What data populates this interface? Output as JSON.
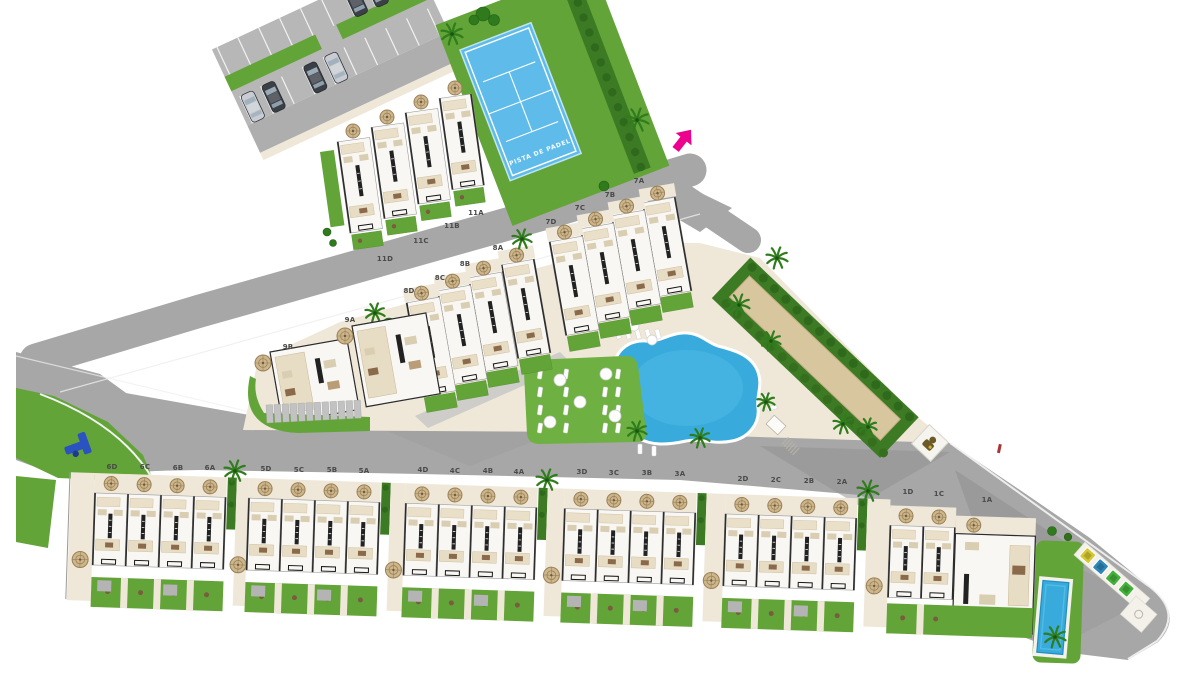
{
  "map": {
    "name": "Residential development site plan",
    "padel_court": {
      "label": "PISTA DE PADEL"
    },
    "unit_labels": [
      {
        "text": "11A",
        "x": 476,
        "y": 215
      },
      {
        "text": "11B",
        "x": 452,
        "y": 228
      },
      {
        "text": "11C",
        "x": 421,
        "y": 243
      },
      {
        "text": "11D",
        "x": 385,
        "y": 261
      },
      {
        "text": "7A",
        "x": 639,
        "y": 183
      },
      {
        "text": "7B",
        "x": 610,
        "y": 197
      },
      {
        "text": "7C",
        "x": 580,
        "y": 210
      },
      {
        "text": "7D",
        "x": 551,
        "y": 224
      },
      {
        "text": "8A",
        "x": 498,
        "y": 250
      },
      {
        "text": "8B",
        "x": 465,
        "y": 266
      },
      {
        "text": "8C",
        "x": 440,
        "y": 280
      },
      {
        "text": "8D",
        "x": 409,
        "y": 293
      },
      {
        "text": "9A",
        "x": 350,
        "y": 322
      },
      {
        "text": "9B",
        "x": 288,
        "y": 349
      },
      {
        "text": "6D",
        "x": 112,
        "y": 469
      },
      {
        "text": "6C",
        "x": 145,
        "y": 469
      },
      {
        "text": "6B",
        "x": 178,
        "y": 470
      },
      {
        "text": "6A",
        "x": 210,
        "y": 470
      },
      {
        "text": "5D",
        "x": 266,
        "y": 471
      },
      {
        "text": "5C",
        "x": 299,
        "y": 472
      },
      {
        "text": "5B",
        "x": 332,
        "y": 472
      },
      {
        "text": "5A",
        "x": 364,
        "y": 473
      },
      {
        "text": "4D",
        "x": 423,
        "y": 472
      },
      {
        "text": "4C",
        "x": 455,
        "y": 473
      },
      {
        "text": "4B",
        "x": 488,
        "y": 473
      },
      {
        "text": "4A",
        "x": 519,
        "y": 474
      },
      {
        "text": "3D",
        "x": 582,
        "y": 474
      },
      {
        "text": "3C",
        "x": 614,
        "y": 475
      },
      {
        "text": "3B",
        "x": 647,
        "y": 475
      },
      {
        "text": "3A",
        "x": 680,
        "y": 476
      },
      {
        "text": "2D",
        "x": 743,
        "y": 481
      },
      {
        "text": "2C",
        "x": 776,
        "y": 482
      },
      {
        "text": "2B",
        "x": 809,
        "y": 483
      },
      {
        "text": "2A",
        "x": 842,
        "y": 484
      },
      {
        "text": "1D",
        "x": 908,
        "y": 494
      },
      {
        "text": "1C",
        "x": 939,
        "y": 496
      },
      {
        "text": "1A",
        "x": 987,
        "y": 502
      }
    ],
    "features": {
      "entrance": "site entrance arrow",
      "padel_court": "padel court",
      "parking": "parking lot with cars",
      "communal_pool": "communal free-form swimming pool",
      "solarium": "sun lounger lawn",
      "orchard": "community garden strip",
      "playground": "children playground",
      "recycling_point": "recycling bins",
      "private_pool": "private lap pool of unit 1A",
      "guard_statue": "guard figure tile"
    },
    "recycling_bin_colors": [
      "#d6c832",
      "#2f86b8",
      "#45b13b",
      "#45b13b"
    ],
    "colors": {
      "road": "#a7a7a7",
      "road_light": "#b7b7b7",
      "road_dark": "#929292",
      "grass": "#63a438",
      "grass_light": "#6fb042",
      "hedge": "#3c7a24",
      "deck": "#efe8d8",
      "deck_path": "#f3f1ea",
      "pool_water": "#38abdc",
      "pool_water_light": "#55bde6",
      "padel_blue": "#5fbbe9",
      "house_white": "#f8f7f3",
      "terrace_tan": "#cdb68c",
      "terrace_dark": "#9a8058",
      "orchard_sand": "#d8c69e",
      "car_dark": "#3b4047",
      "car_silver": "#c9ccd2",
      "playground_blue": "#2a52c0",
      "entrance_arrow": "#ec008c",
      "gate_red": "#a83434",
      "label_text": "#4a4a4a"
    }
  }
}
